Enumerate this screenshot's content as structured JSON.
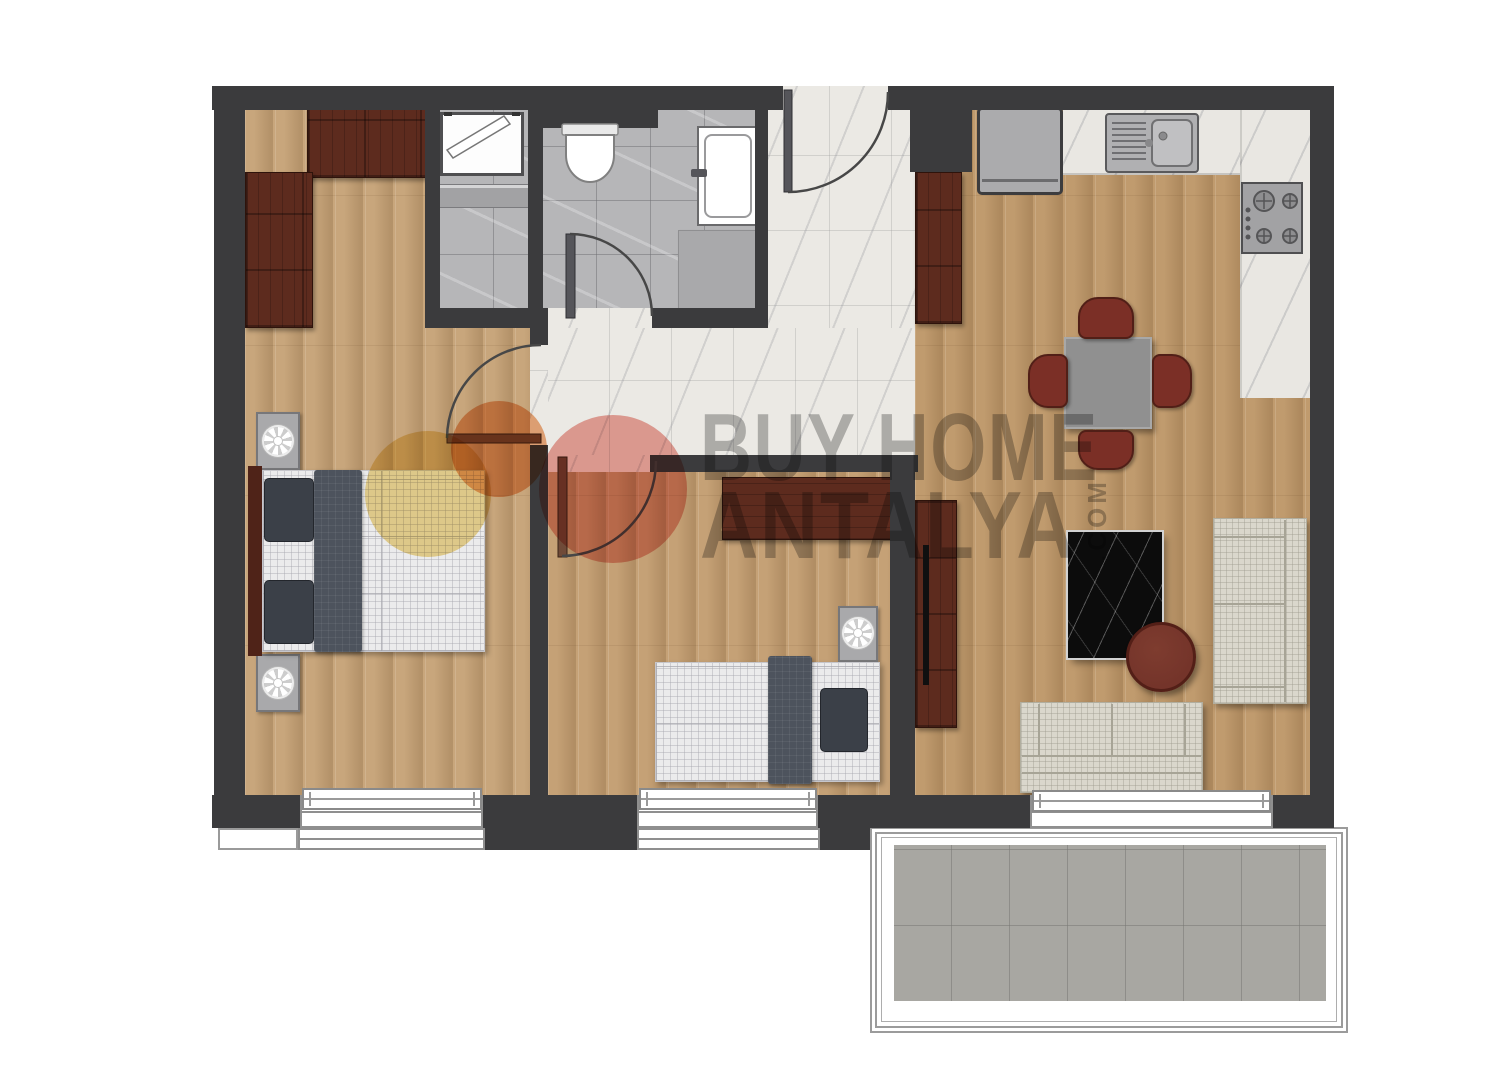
{
  "watermark": {
    "line1": "BUY HOME",
    "line2": "ANTALYA",
    "suffix": ".COM",
    "text_color": "rgba(104,104,104,0.45)",
    "logo_yellow": "rgba(236,206,118,0.78)",
    "logo_orange": "rgba(233,146,84,0.75)",
    "logo_pink": "rgba(230,128,118,0.70)"
  },
  "palette": {
    "wall": "#3b3b3d",
    "wood_master": "#c8a67c",
    "wood_bedroom2": "#c5a176",
    "wood_living": "#c09b6e",
    "marble": "#ebe9e4",
    "tile_bath": "#b6b6b8",
    "tile_balcony": "#a8a7a2",
    "cabinet_wood": "#5d2b1e",
    "door_leaf": "#6f4a38",
    "arc": "#474747",
    "sofa": "#dad7cc",
    "mattress": "#ebebec",
    "blanket": "#4d535d",
    "pillow": "#3b4048",
    "rug": "#0c0c0c",
    "chair": "#7b2f26",
    "coffee_table": "#74342a",
    "dining_table": "#909090",
    "appliance": "#a9a9ab",
    "counter_marble": "#e9e7e2"
  }
}
